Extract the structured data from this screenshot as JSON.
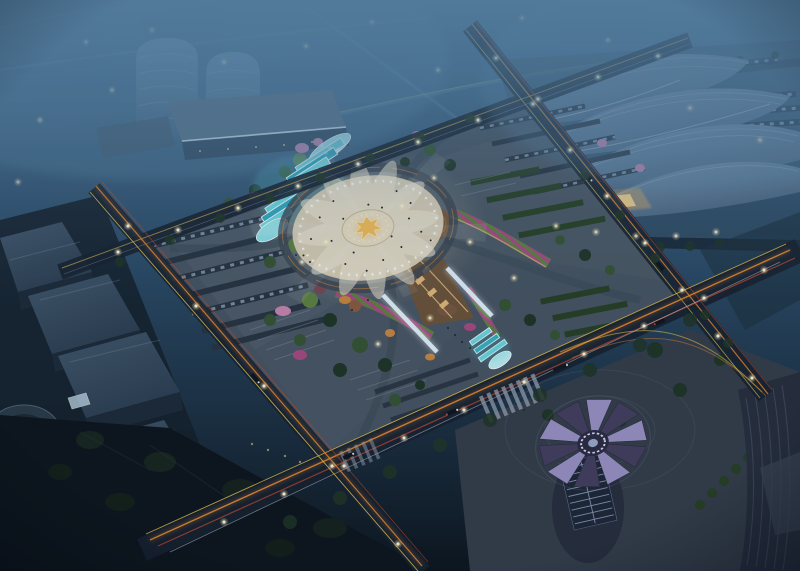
{
  "scene": {
    "type": "aerial-night-architectural-rendering",
    "description": "Night aerial rendering of an illuminated civic plaza: a radial lotus plaza with a gold-lit sculpture, cascading cyan fountain terraces, sunken white-light corridors, terraced gardens with pink flower ribbons, parking rows, and perimeter boulevards streaked with orange light trails; a wave-shell exhibition center sits top right, flat-roofed exhibition halls left, a petal-crowned tower bottom right, all fading into a foggy blue city.",
    "landmarks": [
      "central-lotus-plaza",
      "lotus-sculpture",
      "cascade-fountain",
      "sunken-light-corridor",
      "corridor-fountain",
      "amphitheater-garden",
      "flower-ribbons",
      "terraced-gardens",
      "parking-rows",
      "exhibition-center-shell-roofs",
      "west-exhibition-halls",
      "drum-pavilion",
      "cylindrical-towers",
      "podium-building",
      "flower-crown-tower",
      "curved-office-building",
      "perimeter-boulevards",
      "light-trails",
      "street-lamps",
      "crosswalk",
      "city-fog",
      "dark-park"
    ]
  },
  "palette": {
    "sky_top": "#4a7392",
    "sky_mid": "#2b4a66",
    "ground_dark": "#0b1219",
    "fog": "#5a84a6",
    "haze_city": "#3f607e",
    "tower_light": "#6e93b0",
    "tower_dark": "#3d5c78",
    "shell_light": "#7d98b3",
    "shell_dark": "#47617b",
    "shell_rib": "#aabfd4",
    "hall_roof": "#42566a",
    "hall_side": "#1b2836",
    "road_dark": "#16202c",
    "plaza_base": "#46525f",
    "plaza_light": "#566371",
    "circle_pave": "#d8ccb3",
    "petal_light": "#f0e8d3",
    "sculpture_gold": "#f4bc55",
    "gold_deep": "#ffb84d",
    "water_cyan": "#6fd6de",
    "water_deep": "#2fa8bc",
    "water_edge": "#ebfdff",
    "trail_orange": "#f08a2c",
    "trail_red": "#d14a28",
    "trail_yellow": "#f6cf4e",
    "headlight_white": "#e9f1ff",
    "lamp_glow": "#ffeab0",
    "lamp_core": "#fff8dd",
    "tree_green": "#35522f",
    "tree_dark": "#1f3322",
    "tree_bright": "#5d7f3f",
    "flower_pink": "#c983ad",
    "flower_magenta": "#a8487f",
    "shrub_orange": "#c9843d",
    "hedge_green": "#263e21",
    "corridor_warm": "#6e5133",
    "corridor_light": "#e3b878",
    "strip_white": "#e9f5ff",
    "amph_brown": "#77573a",
    "petal_lavender": "#9a90c2",
    "petal_dark": "#433c5c",
    "tower_body": "#262b38",
    "window_line": "#97a8c4",
    "park_dark": "#0c1218",
    "pave_br": "#343b47",
    "building_right": "#262c3a",
    "car_row": "#8a9cb0",
    "row_base": "#27313d",
    "people": "#20242c"
  }
}
